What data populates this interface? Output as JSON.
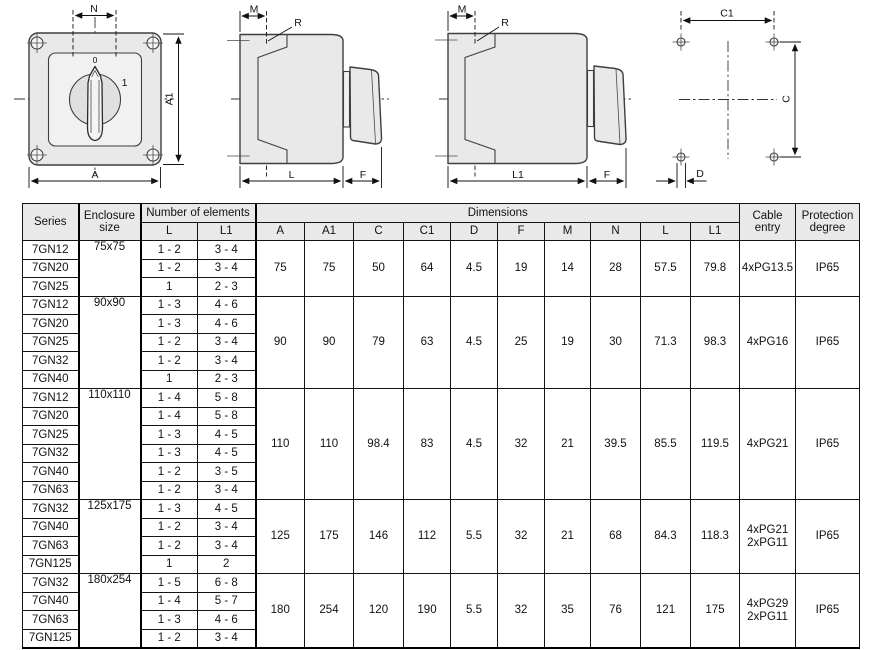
{
  "drawings": {
    "front_view": {
      "label_n": "N",
      "label_a1": "A1",
      "label_a": "A",
      "pos_zero": "0",
      "pos_one": "1"
    },
    "side_view_l": {
      "label_m": "M",
      "label_r": "R",
      "label_l": "L",
      "label_f": "F"
    },
    "side_view_l1": {
      "label_m": "M",
      "label_r": "R",
      "label_l1": "L1",
      "label_f": "F"
    },
    "drill_template": {
      "label_c1": "C1",
      "label_c": "C",
      "label_d": "D"
    }
  },
  "table": {
    "header": {
      "series": "Series",
      "enclosure": "Enclosure size",
      "elements": "Number of elements",
      "dimensions": "Dimensions",
      "cable": "Cable entry",
      "protection": "Protection degree",
      "sub": {
        "l": "L",
        "l1": "L1",
        "a": "A",
        "a1": "A1",
        "c": "C",
        "c1": "C1",
        "d": "D",
        "f": "F",
        "m": "M",
        "n": "N",
        "l_dim": "L",
        "l1_dim": "L1"
      }
    },
    "groups": [
      {
        "size": "75x75",
        "rows": [
          {
            "s": "7GN12",
            "l": "1 - 2",
            "l1": "3 - 4"
          },
          {
            "s": "7GN20",
            "l": "1 - 2",
            "l1": "3 - 4"
          },
          {
            "s": "7GN25",
            "l": "1",
            "l1": "2 - 3"
          }
        ],
        "dims": [
          "75",
          "75",
          "50",
          "64",
          "4.5",
          "19",
          "14",
          "28",
          "57.5",
          "79.8"
        ],
        "cable": "4xPG13.5",
        "ip": "IP65"
      },
      {
        "size": "90x90",
        "rows": [
          {
            "s": "7GN12",
            "l": "1 - 3",
            "l1": "4 - 6"
          },
          {
            "s": "7GN20",
            "l": "1 - 3",
            "l1": "4 - 6"
          },
          {
            "s": "7GN25",
            "l": "1 - 2",
            "l1": "3 - 4"
          },
          {
            "s": "7GN32",
            "l": "1 - 2",
            "l1": "3 - 4"
          },
          {
            "s": "7GN40",
            "l": "1",
            "l1": "2 - 3"
          }
        ],
        "dims": [
          "90",
          "90",
          "79",
          "63",
          "4.5",
          "25",
          "19",
          "30",
          "71.3",
          "98.3"
        ],
        "cable": "4xPG16",
        "ip": "IP65"
      },
      {
        "size": "110x110",
        "rows": [
          {
            "s": "7GN12",
            "l": "1 - 4",
            "l1": "5 - 8"
          },
          {
            "s": "7GN20",
            "l": "1 - 4",
            "l1": "5 - 8"
          },
          {
            "s": "7GN25",
            "l": "1 - 3",
            "l1": "4 - 5"
          },
          {
            "s": "7GN32",
            "l": "1 - 3",
            "l1": "4 - 5"
          },
          {
            "s": "7GN40",
            "l": "1 - 2",
            "l1": "3 - 5"
          },
          {
            "s": "7GN63",
            "l": "1 - 2",
            "l1": "3 - 4"
          }
        ],
        "dims": [
          "110",
          "110",
          "98.4",
          "83",
          "4.5",
          "32",
          "21",
          "39.5",
          "85.5",
          "119.5"
        ],
        "cable": "4xPG21",
        "ip": "IP65"
      },
      {
        "size": "125x175",
        "rows": [
          {
            "s": "7GN32",
            "l": "1 - 3",
            "l1": "4 - 5"
          },
          {
            "s": "7GN40",
            "l": "1 - 2",
            "l1": "3 - 4"
          },
          {
            "s": "7GN63",
            "l": "1 - 2",
            "l1": "3 - 4"
          },
          {
            "s": "7GN125",
            "l": "1",
            "l1": "2"
          }
        ],
        "dims": [
          "125",
          "175",
          "146",
          "112",
          "5.5",
          "32",
          "21",
          "68",
          "84.3",
          "118.3"
        ],
        "cable": "4xPG21 2xPG11",
        "ip": "IP65"
      },
      {
        "size": "180x254",
        "rows": [
          {
            "s": "7GN32",
            "l": "1 - 5",
            "l1": "6 - 8"
          },
          {
            "s": "7GN40",
            "l": "1 - 4",
            "l1": "5 - 7"
          },
          {
            "s": "7GN63",
            "l": "1 - 3",
            "l1": "4 - 6"
          },
          {
            "s": "7GN125",
            "l": "1 - 2",
            "l1": "3 - 4"
          }
        ],
        "dims": [
          "180",
          "254",
          "120",
          "190",
          "5.5",
          "32",
          "35",
          "76",
          "121",
          "175"
        ],
        "cable": "4xPG29 2xPG11",
        "ip": "IP65"
      }
    ]
  }
}
